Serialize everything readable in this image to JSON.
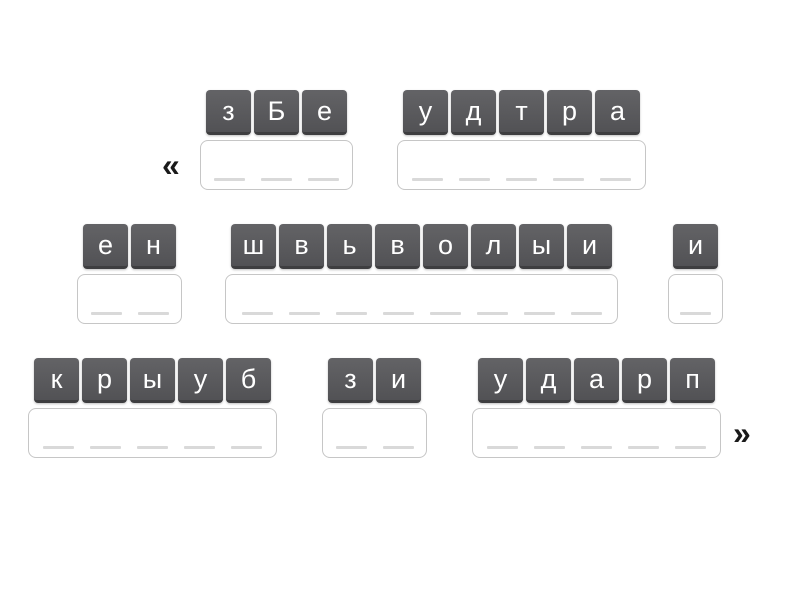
{
  "page": {
    "background": "#ffffff"
  },
  "navigation": {
    "prev_label": "«",
    "next_label": "»"
  },
  "colors": {
    "tile_background_top": "#636366",
    "tile_background_bottom": "#525255",
    "tile_bottom_edge": "#3e3e40",
    "tile_text": "#ffffff",
    "answer_box_border": "#c6c6c6",
    "answer_box_background": "#ffffff",
    "slot_line": "#d9d9d9",
    "arrow": "#1a1a1a"
  },
  "groups": [
    {
      "id": "group-1",
      "tiles": [
        "з",
        "Б",
        "е"
      ],
      "slots": 3
    },
    {
      "id": "group-2",
      "tiles": [
        "у",
        "д",
        "т",
        "р",
        "а"
      ],
      "slots": 5
    },
    {
      "id": "group-3",
      "tiles": [
        "е",
        "н"
      ],
      "slots": 2
    },
    {
      "id": "group-4",
      "tiles": [
        "ш",
        "в",
        "ь",
        "в",
        "о",
        "л",
        "ы",
        "и"
      ],
      "slots": 8
    },
    {
      "id": "group-5",
      "tiles": [
        "и"
      ],
      "slots": 1
    },
    {
      "id": "group-6",
      "tiles": [
        "к",
        "р",
        "ы",
        "у",
        "б"
      ],
      "slots": 5
    },
    {
      "id": "group-7",
      "tiles": [
        "з",
        "и"
      ],
      "slots": 2
    },
    {
      "id": "group-8",
      "tiles": [
        "у",
        "д",
        "а",
        "р",
        "п"
      ],
      "slots": 5
    }
  ]
}
